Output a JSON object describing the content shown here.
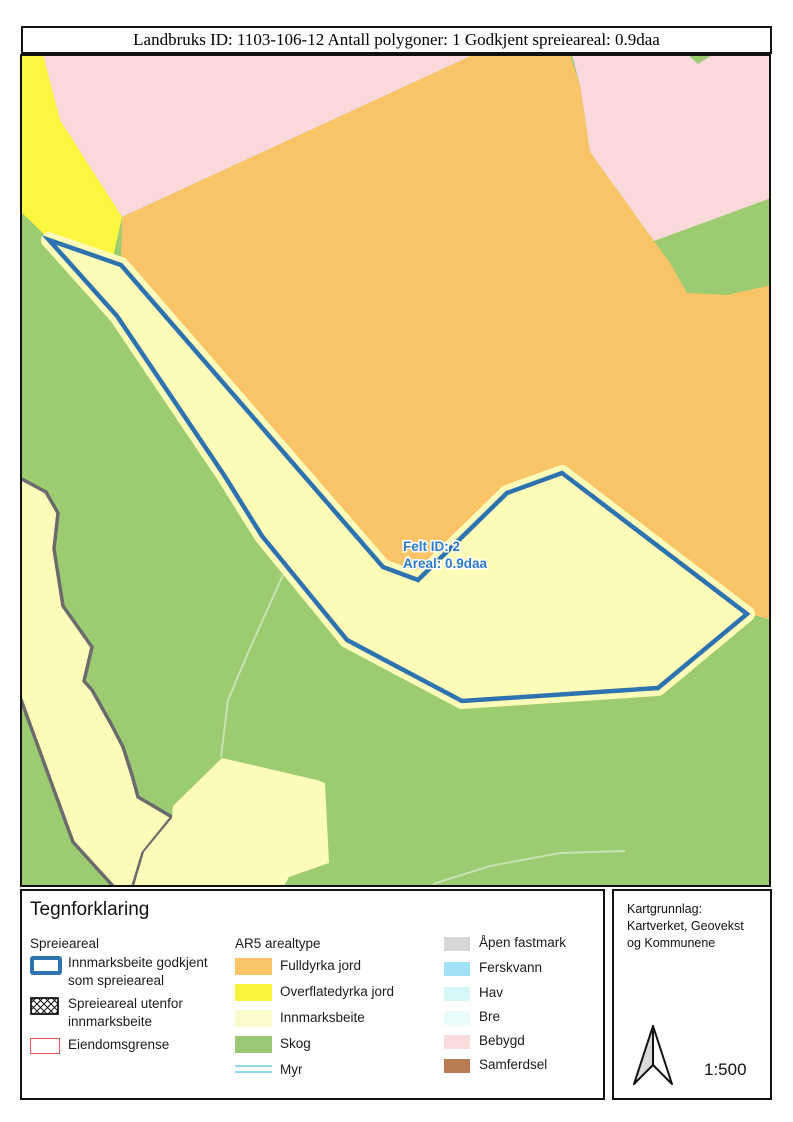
{
  "title_bar": {
    "text": "Landbruks ID: 1103-106-12 Antall polygoner: 1 Godkjent spreieareal: 0.9daa"
  },
  "map": {
    "feature_label": {
      "line1": "Felt ID: 2",
      "line2": "Areal: 0.9daa",
      "color": "#2d7cc9"
    },
    "colors": {
      "skog": "#9ccb72",
      "fulldyrka_jord": "#f9c467",
      "overflatedyrka_jord": "#fbf740",
      "innmarksbeite": "#fcfcb8",
      "bebygd": "#f9d9da",
      "spreieareal_outline": "#2f72b0",
      "grense_gray": "#6b6b6b",
      "sti": "#ffffff73",
      "border": "#111111"
    }
  },
  "legend": {
    "heading": "Tegnforklaring",
    "group1": {
      "label": "Spreieareal",
      "outline_blue": "#2f72b0",
      "outline_red": "#e05555",
      "items": [
        {
          "label_line1": "Innmarksbeite godkjent",
          "label_line2": "som spreieareal"
        },
        {
          "label_line1": "Spreieareal utenfor",
          "label_line2": "innmarksbeite"
        },
        {
          "label_line1": "Eiendomsgrense"
        }
      ]
    },
    "group2": {
      "label": "AR5 arealtype",
      "items": [
        {
          "label": "Fulldyrka jord",
          "color": "#f9c467"
        },
        {
          "label": "Overflatedyrka jord",
          "color": "#fbf43c"
        },
        {
          "label": "Innmarksbeite",
          "color": "#fbfaca"
        },
        {
          "label": "Skog",
          "color": "#9cc873"
        },
        {
          "label": "Myr",
          "color": "#8fd9f2"
        }
      ]
    },
    "group3": {
      "items": [
        {
          "label": "Åpen fastmark",
          "color": "#d6d6d6"
        },
        {
          "label": "Ferskvann",
          "color": "#a2e1f8"
        },
        {
          "label": "Hav",
          "color": "#d7f6f8"
        },
        {
          "label": "Bre",
          "color": "#e9fbfb"
        },
        {
          "label": "Bebygd",
          "color": "#fadcdc"
        },
        {
          "label": "Samferdsel",
          "color": "#b87c52"
        }
      ]
    }
  },
  "info_panel": {
    "source_line1": "Kartgrunnlag:",
    "source_line2": "Kartverket, Geovekst",
    "source_line3": "og Kommunene",
    "scale": "1:500"
  }
}
